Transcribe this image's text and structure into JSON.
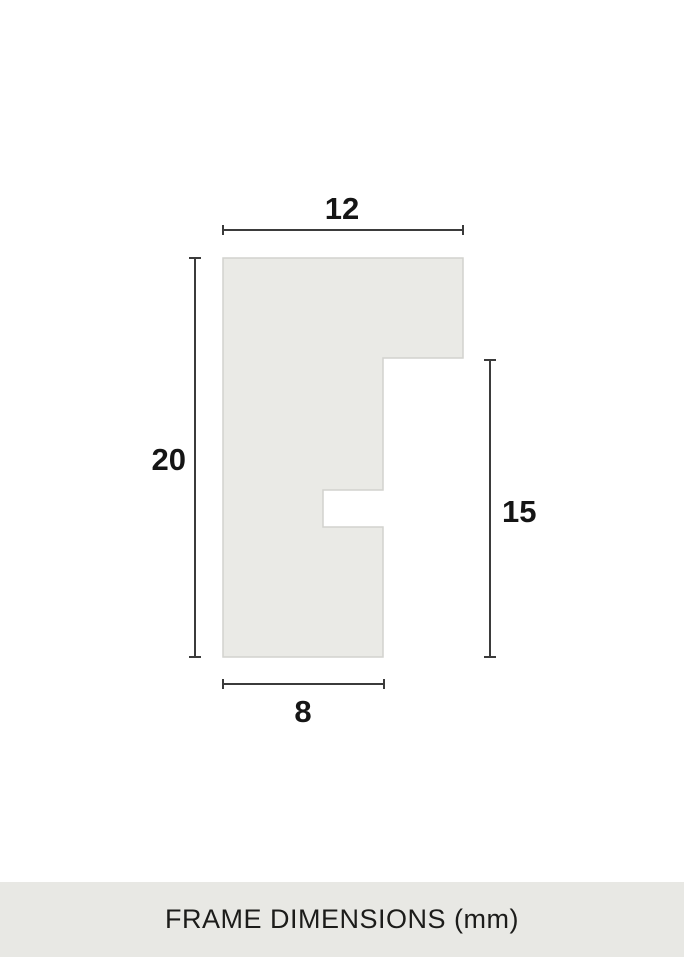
{
  "diagram": {
    "dimensions": {
      "top_width": "12",
      "left_height": "20",
      "right_height": "15",
      "bottom_width": "8"
    }
  },
  "footer": {
    "label": "FRAME DIMENSIONS (mm)"
  },
  "colors": {
    "page_bg": "#FFFFFF",
    "shape_fill": "#EAEAE6",
    "shape_border": "#D2D2CE",
    "dimension_line": "#3B3B3B",
    "label_text": "#151515",
    "footer_bg": "#E8E8E4",
    "footer_text": "#1C1C1A"
  }
}
